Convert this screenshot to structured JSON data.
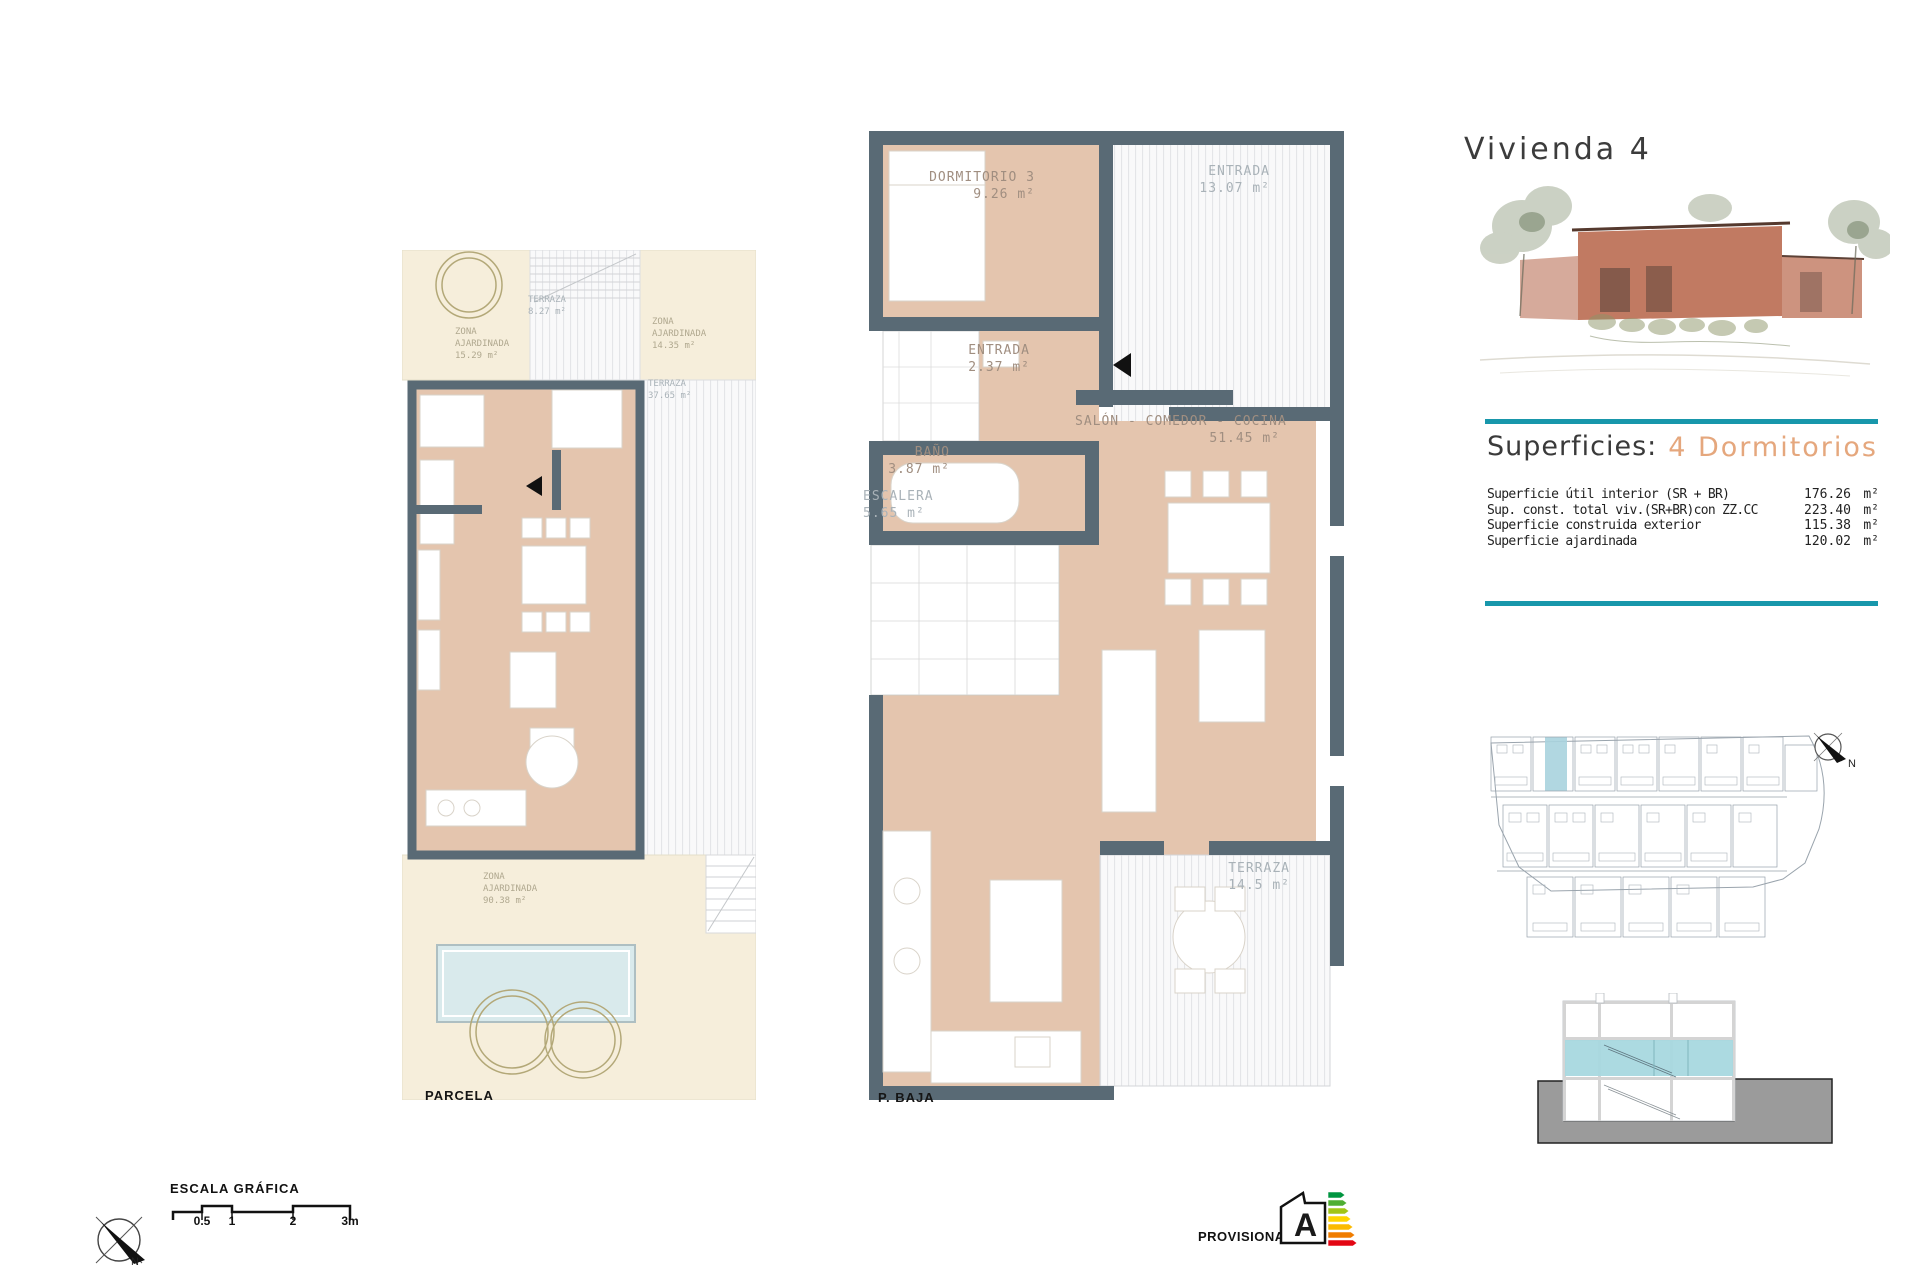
{
  "page": {
    "title": "Vivienda 4"
  },
  "plans": {
    "parcela": {
      "caption": "PARCELA",
      "zones": [
        {
          "name": "TERRAZA",
          "area": "8.27 m²"
        },
        {
          "name": "ZONA AJARDINADA",
          "area": "15.29 m²"
        },
        {
          "name": "ZONA AJARDINADA",
          "area": "14.35 m²"
        },
        {
          "name": "TERRAZA",
          "area": "37.65 m²"
        },
        {
          "name": "ZONA AJARDINADA",
          "area": "90.38 m²"
        }
      ]
    },
    "p_baja": {
      "caption": "P. BAJA",
      "rooms": [
        {
          "name": "DORMITORIO 3",
          "area": "9.26 m²"
        },
        {
          "name": "ENTRADA",
          "area": "13.07 m²"
        },
        {
          "name": "ENTRADA",
          "area": "2.37 m²"
        },
        {
          "name": "BAÑO",
          "area": "3.87 m²"
        },
        {
          "name": "ESCALERA",
          "area": "5.65 m²"
        },
        {
          "name": "SALÓN - COMEDOR - COCINA",
          "area": "51.45 m²"
        },
        {
          "name": "TERRAZA",
          "area": "14.5 m²"
        }
      ]
    }
  },
  "superficies": {
    "heading": "Superficies:",
    "subheading": "4 Dormitorios",
    "rows": [
      {
        "label": "Superficie útil interior (SR + BR)",
        "value": "176.26",
        "unit": "m²"
      },
      {
        "label": "Sup. const. total viv.(SR+BR)con ZZ.CC",
        "value": "223.40",
        "unit": "m²"
      },
      {
        "label": "Superficie construida exterior",
        "value": "115.38",
        "unit": "m²"
      },
      {
        "label": "Superficie ajardinada",
        "value": "120.02",
        "unit": "m²"
      }
    ]
  },
  "footer": {
    "scale_title": "ESCALA GRÁFICA",
    "scale_ticks": [
      "0.5",
      "1",
      "2",
      "3m"
    ],
    "north_label": "N",
    "provisional": "PROVISIONAL",
    "energy_rating": "A",
    "energy_colors": [
      "#009540",
      "#4fae32",
      "#a2c517",
      "#ffd500",
      "#fbba00",
      "#f07d00",
      "#e30613"
    ]
  },
  "colors": {
    "accent_teal": "#1897ab",
    "wall": "#596a75",
    "floor_tan": "#e4c5ae",
    "garden_beige": "#f6eedb",
    "highlight_blue": "#a9d3de",
    "section_blue": "#a8d8df",
    "ground_grey": "#9b9b9b",
    "subheading_tan": "#e5a77d"
  }
}
